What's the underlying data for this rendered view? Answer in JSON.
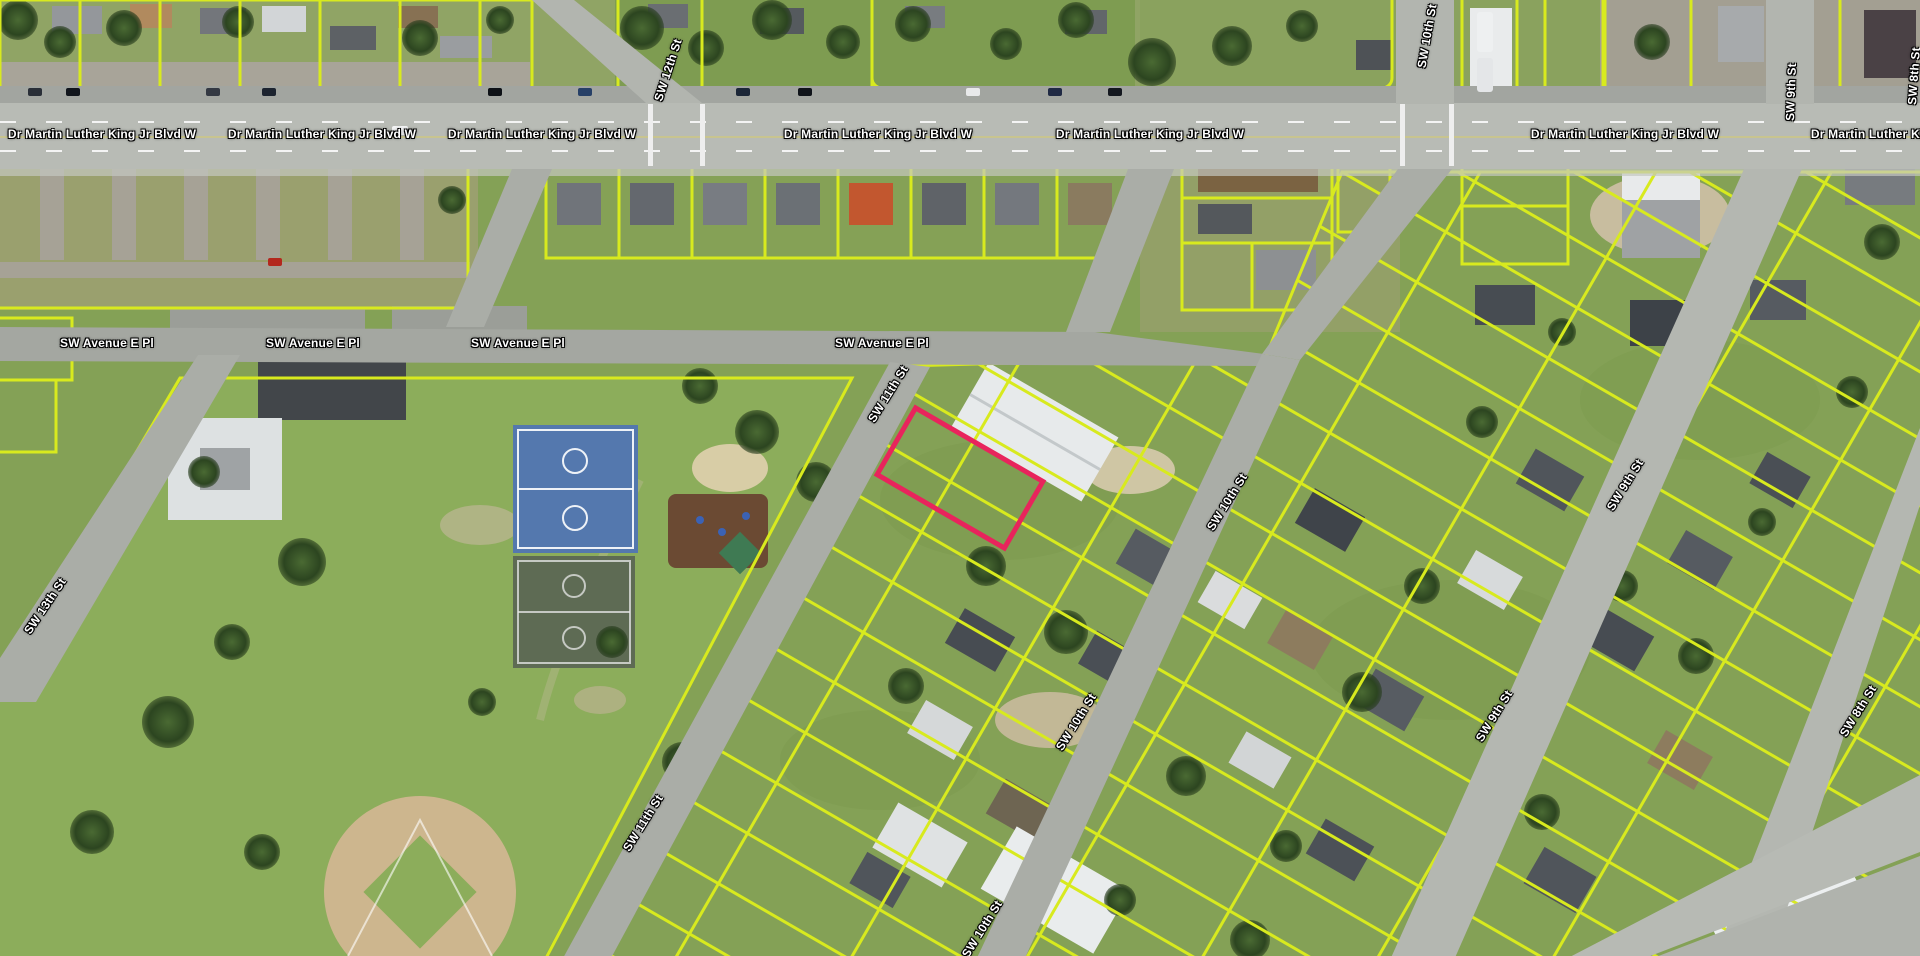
{
  "map": {
    "view": "aerial parcel map",
    "colors": {
      "parcel_outline": "#d8ea1e",
      "selected_parcel_outline": "#e8245c",
      "road_label_text": "#ffffff",
      "road_label_halo": "#000000"
    },
    "selected_parcel": {
      "shape": "rotated-rectangle",
      "center_x": 960,
      "center_y": 478,
      "width": 142,
      "height": 72,
      "rotation_deg": 30
    },
    "street_labels": [
      {
        "text": "Dr Martin Luther King Jr Blvd W",
        "x": 102,
        "y": 134,
        "rotation": 0
      },
      {
        "text": "Dr Martin Luther King Jr Blvd W",
        "x": 322,
        "y": 134,
        "rotation": 0
      },
      {
        "text": "Dr Martin Luther King Jr Blvd W",
        "x": 542,
        "y": 134,
        "rotation": 0
      },
      {
        "text": "Dr Martin Luther King Jr Blvd W",
        "x": 878,
        "y": 134,
        "rotation": 0
      },
      {
        "text": "Dr Martin Luther King Jr Blvd W",
        "x": 1150,
        "y": 134,
        "rotation": 0
      },
      {
        "text": "Dr Martin Luther King Jr Blvd W",
        "x": 1625,
        "y": 134,
        "rotation": 0
      },
      {
        "text": "Dr Martin Luther King Jr Blvd W",
        "x": 1905,
        "y": 134,
        "rotation": 0
      },
      {
        "text": "SW Avenue E Pl",
        "x": 107,
        "y": 343,
        "rotation": 0
      },
      {
        "text": "SW Avenue E Pl",
        "x": 313,
        "y": 343,
        "rotation": 0
      },
      {
        "text": "SW Avenue E Pl",
        "x": 518,
        "y": 343,
        "rotation": 0
      },
      {
        "text": "SW Avenue E Pl",
        "x": 882,
        "y": 343,
        "rotation": 0
      },
      {
        "text": "SW 12th St",
        "x": 668,
        "y": 70,
        "rotation": -72
      },
      {
        "text": "SW 10th St",
        "x": 1427,
        "y": 36,
        "rotation": -80
      },
      {
        "text": "SW 9th St",
        "x": 1791,
        "y": 92,
        "rotation": -88
      },
      {
        "text": "SW 8th St",
        "x": 1914,
        "y": 76,
        "rotation": -86
      },
      {
        "text": "SW 11th St",
        "x": 888,
        "y": 394,
        "rotation": -58
      },
      {
        "text": "SW 11th St",
        "x": 643,
        "y": 823,
        "rotation": -58
      },
      {
        "text": "SW 10th St",
        "x": 1227,
        "y": 502,
        "rotation": -58
      },
      {
        "text": "SW 10th St",
        "x": 1076,
        "y": 722,
        "rotation": -58
      },
      {
        "text": "SW 10th St",
        "x": 982,
        "y": 929,
        "rotation": -58
      },
      {
        "text": "SW 9th St",
        "x": 1625,
        "y": 485,
        "rotation": -58
      },
      {
        "text": "SW 9th St",
        "x": 1494,
        "y": 716,
        "rotation": -58
      },
      {
        "text": "SW 8th St",
        "x": 1858,
        "y": 711,
        "rotation": -58
      },
      {
        "text": "SW 13th St",
        "x": 45,
        "y": 606,
        "rotation": -56
      }
    ],
    "landmarks": {
      "basketball_courts_color": "#5478ae",
      "baseball_infield_color": "#cdb68e",
      "playground_surface_color": "#6b4a33"
    }
  }
}
